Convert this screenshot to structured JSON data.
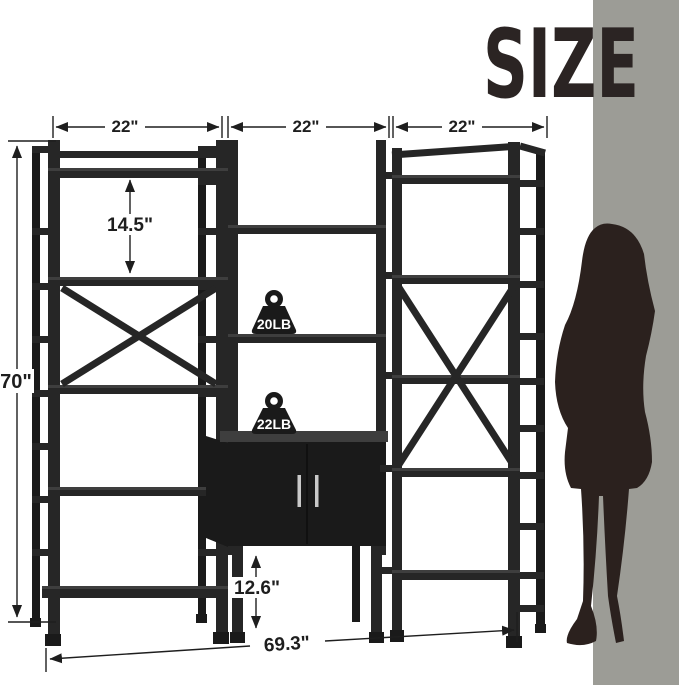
{
  "title": "SIZE",
  "annotations": {
    "left_section_width": "22\"",
    "middle_section_width": "22\"",
    "right_section_width": "22\"",
    "shelf_spacing": "14.5\"",
    "overall_height": "70\"",
    "bottom_clearance": "12.6\"",
    "overall_width": "69.3\""
  },
  "weights": {
    "shelf_capacity_label": "20LB",
    "cabinet_top_capacity_label": "22LB"
  },
  "colors": {
    "background": "#ffffff",
    "wall": "#9c9c96",
    "furniture": "#262626",
    "furniture-dark": "#1a1a1a",
    "furniture-light": "#3e3e3e",
    "silhouette": "#2b211e",
    "title": "#2b2423",
    "dimension": "#1e1e1e",
    "handle": "#c9c9c9",
    "label-bg": "#ffffff"
  }
}
